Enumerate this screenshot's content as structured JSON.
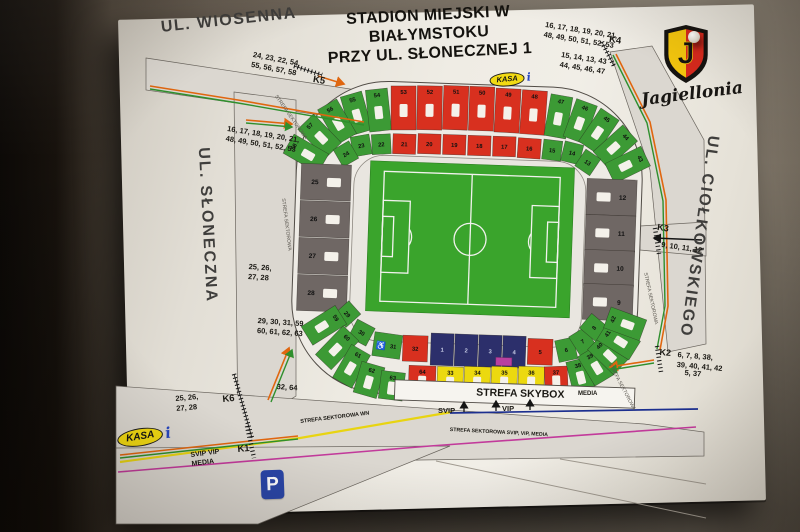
{
  "scene": {
    "wall_dark": "#0b0907",
    "wall_light": "#8a8173",
    "poster_color": "#efece4"
  },
  "title": {
    "line1": "STADION MIEJSKI W",
    "line2": "BIAŁYMSTOKU",
    "line3": "PRZY UL. SŁONECZNEJ 1"
  },
  "logo": {
    "name": "Jagiellonia",
    "initial": "J",
    "shield_yellow": "#f2c50e",
    "shield_red": "#d5291d"
  },
  "map": {
    "kasa_label": "KASA",
    "info_label": "i",
    "parking_label": "P",
    "skybox_label": "STREFA SKYBOX",
    "labels": [
      {
        "name": "street-wiosenna",
        "text": "UL. WIOSENNA",
        "x": 160,
        "y": 18,
        "rot": -6,
        "size": 16,
        "color": "#3f3e3c",
        "ls": 1.5
      },
      {
        "name": "sector-list-nw",
        "text": "24, 23, 22, 54,\n55, 56, 57, 58",
        "x": 254,
        "y": 50,
        "rot": 11,
        "size": 7.5
      },
      {
        "name": "gate-label-k5",
        "text": "K5",
        "x": 314,
        "y": 74,
        "rot": 10,
        "size": 9.5
      },
      {
        "name": "strefa-road-nw",
        "text": "STREFA SEKTOROWA",
        "x": 278,
        "y": 94,
        "rot": 55,
        "size": 5,
        "color": "#5a564f",
        "bold": false
      },
      {
        "name": "sector-list-w",
        "text": "16, 17, 18, 19, 20, 21,\n48, 49, 50, 51, 52, 53",
        "x": 228,
        "y": 124,
        "rot": 9,
        "size": 7.5
      },
      {
        "name": "street-sloneczna",
        "text": "UL. SŁONECZNA",
        "x": 192,
        "y": 148,
        "rot": -3,
        "size": 16,
        "color": "#3f3e3c",
        "vertical": true,
        "ls": 2
      },
      {
        "name": "strefa-road-w",
        "text": "STREFA SEKTOROWA",
        "x": 286,
        "y": 198,
        "rot": 83,
        "size": 5,
        "color": "#5a564f",
        "bold": false
      },
      {
        "name": "sector-list-w2",
        "text": "25, 26,\n27, 28",
        "x": 249,
        "y": 262,
        "rot": 4,
        "size": 7.5
      },
      {
        "name": "sector-list-sw",
        "text": "29, 30, 31, 59\n60, 61, 62, 63",
        "x": 258,
        "y": 316,
        "rot": 4,
        "size": 7.5
      },
      {
        "name": "sector-list-sw2",
        "text": "32, 64",
        "x": 277,
        "y": 382,
        "rot": 4,
        "size": 7.5
      },
      {
        "name": "sector-list-k6",
        "text": "25, 26,\n27, 28",
        "x": 175,
        "y": 394,
        "rot": -5,
        "size": 7.5
      },
      {
        "name": "gate-label-k6",
        "text": "K6",
        "x": 222,
        "y": 394,
        "rot": -5,
        "size": 9.5
      },
      {
        "name": "route-label-svip-vip-media",
        "text": "SVIP  VIP\nMEDIA",
        "x": 190,
        "y": 451,
        "rot": -7,
        "size": 7
      },
      {
        "name": "gate-label-k1",
        "text": "K1",
        "x": 237,
        "y": 444,
        "rot": -5,
        "size": 9.5
      },
      {
        "name": "strefa-sektorowa-wn",
        "text": "STREFA SEKTOROWA WN",
        "x": 300,
        "y": 419,
        "rot": -7,
        "size": 5.5
      },
      {
        "name": "svip-label",
        "text": "SVIP",
        "x": 438,
        "y": 406,
        "rot": 0,
        "size": 7.5
      },
      {
        "name": "vip-label",
        "text": "VIP",
        "x": 502,
        "y": 404,
        "rot": 0,
        "size": 7.5
      },
      {
        "name": "strefa-sektorowa-svip",
        "text": "STREFA SEKTOROWA SVIP, VIP, MEDIA",
        "x": 450,
        "y": 427,
        "rot": 3,
        "size": 5.2
      },
      {
        "name": "media-label",
        "text": "MEDIA",
        "x": 578,
        "y": 391,
        "rot": 0,
        "size": 6
      },
      {
        "name": "sector-list-ne",
        "text": "16, 17, 18, 19, 20, 21,\n48, 49, 50, 51, 52, 53",
        "x": 546,
        "y": 20,
        "rot": 9,
        "size": 7.5
      },
      {
        "name": "gate-label-k4",
        "text": "K4",
        "x": 610,
        "y": 34,
        "rot": 9,
        "size": 9.5
      },
      {
        "name": "sector-list-ne2",
        "text": "15, 14, 13, 43\n44, 45, 46, 47",
        "x": 562,
        "y": 50,
        "rot": 9,
        "size": 7.5
      },
      {
        "name": "street-ciolkowskiego",
        "text": "UL. CIOŁKOWSKIEGO",
        "x": 702,
        "y": 134,
        "rot": 8,
        "size": 16,
        "color": "#3f3e3c",
        "vertical": true,
        "ls": 2
      },
      {
        "name": "strefa-road-e",
        "text": "STREFA SEKTOROWA",
        "x": 648,
        "y": 272,
        "rot": 78,
        "size": 5,
        "color": "#5a564f",
        "bold": false
      },
      {
        "name": "gate-label-k3",
        "text": "K3",
        "x": 658,
        "y": 222,
        "rot": 8,
        "size": 9
      },
      {
        "name": "sector-list-e",
        "text": "9, 10, 11, 12",
        "x": 662,
        "y": 240,
        "rot": 8,
        "size": 7.5
      },
      {
        "name": "gate-label-k2",
        "text": "K2",
        "x": 660,
        "y": 347,
        "rot": 5,
        "size": 9
      },
      {
        "name": "sector-list-se",
        "text": "6, 7, 8, 38,\n39, 40, 41, 42",
        "x": 678,
        "y": 350,
        "rot": 5,
        "size": 7.5
      },
      {
        "name": "sector-list-se2",
        "text": "5, 37",
        "x": 685,
        "y": 368,
        "rot": 5,
        "size": 7.5
      },
      {
        "name": "strefa-road-se",
        "text": "STREFA SEKTOROWA",
        "x": 612,
        "y": 362,
        "rot": 62,
        "size": 5,
        "color": "#5a564f",
        "bold": false
      }
    ]
  },
  "stadium": {
    "colors": {
      "red": "#d8301f",
      "green": "#3c9a35",
      "gray": "#6f6764",
      "navy": "#2c2f6b",
      "yellow": "#ecd90f",
      "magenta": "#b8409f",
      "pitch": "#3aa42c",
      "ring": "#eeebe5",
      "slot": "#f4f1ea"
    },
    "wheelchair_symbol": "♿",
    "sectors": [
      {
        "n": "55",
        "x": 352,
        "y": 117,
        "w": 22,
        "h": 40,
        "r": -18,
        "c": "green",
        "s": "c"
      },
      {
        "n": "54",
        "x": 374,
        "y": 113,
        "w": 22,
        "h": 42,
        "r": -8,
        "c": "green",
        "s": "c"
      },
      {
        "n": "53",
        "x": 399,
        "y": 110,
        "w": 25,
        "h": 44,
        "r": -2,
        "c": "red",
        "s": "c"
      },
      {
        "n": "52",
        "x": 425,
        "y": 109,
        "w": 25,
        "h": 44,
        "r": -1,
        "c": "red",
        "s": "c"
      },
      {
        "n": "51",
        "x": 451,
        "y": 108,
        "w": 25,
        "h": 44,
        "r": 0,
        "c": "red",
        "s": "c"
      },
      {
        "n": "50",
        "x": 477,
        "y": 108,
        "w": 25,
        "h": 44,
        "r": 0,
        "c": "red",
        "s": "c"
      },
      {
        "n": "49",
        "x": 503,
        "y": 109,
        "w": 25,
        "h": 44,
        "r": 1,
        "c": "red",
        "s": "c"
      },
      {
        "n": "48",
        "x": 529,
        "y": 110,
        "w": 25,
        "h": 44,
        "r": 2,
        "c": "red",
        "s": "c"
      },
      {
        "n": "47",
        "x": 554,
        "y": 113,
        "w": 22,
        "h": 42,
        "r": 8,
        "c": "green",
        "s": "c"
      },
      {
        "n": "46",
        "x": 576,
        "y": 117,
        "w": 22,
        "h": 40,
        "r": 18,
        "c": "green",
        "s": "c"
      },
      {
        "n": "56",
        "x": 333,
        "y": 126,
        "w": 22,
        "h": 40,
        "r": -32,
        "c": "green",
        "s": "c"
      },
      {
        "n": "57",
        "x": 316,
        "y": 141,
        "w": 22,
        "h": 40,
        "r": -46,
        "c": "green",
        "s": "c"
      },
      {
        "n": "58",
        "x": 303,
        "y": 159,
        "w": 22,
        "h": 40,
        "r": -62,
        "c": "green",
        "s": "c"
      },
      {
        "n": "45",
        "x": 595,
        "y": 126,
        "w": 22,
        "h": 40,
        "r": 32,
        "c": "green",
        "s": "c"
      },
      {
        "n": "44",
        "x": 612,
        "y": 141,
        "w": 22,
        "h": 40,
        "r": 46,
        "c": "green",
        "s": "c"
      },
      {
        "n": "43",
        "x": 625,
        "y": 159,
        "w": 22,
        "h": 40,
        "r": 62,
        "c": "green",
        "s": "c"
      },
      {
        "n": "23",
        "x": 358,
        "y": 149,
        "w": 19,
        "h": 20,
        "r": -12,
        "c": "green"
      },
      {
        "n": "22",
        "x": 378,
        "y": 147,
        "w": 19,
        "h": 20,
        "r": -5,
        "c": "green"
      },
      {
        "n": "21",
        "x": 401,
        "y": 146,
        "w": 23,
        "h": 20,
        "r": 0,
        "c": "red"
      },
      {
        "n": "20",
        "x": 426,
        "y": 145,
        "w": 23,
        "h": 20,
        "r": 0,
        "c": "red"
      },
      {
        "n": "19",
        "x": 451,
        "y": 145,
        "w": 23,
        "h": 20,
        "r": 0,
        "c": "red"
      },
      {
        "n": "18",
        "x": 476,
        "y": 145,
        "w": 23,
        "h": 20,
        "r": 0,
        "c": "red"
      },
      {
        "n": "17",
        "x": 501,
        "y": 145,
        "w": 23,
        "h": 20,
        "r": 0,
        "c": "red"
      },
      {
        "n": "16",
        "x": 526,
        "y": 146,
        "w": 23,
        "h": 20,
        "r": 2,
        "c": "red"
      },
      {
        "n": "15",
        "x": 549,
        "y": 147,
        "w": 19,
        "h": 20,
        "r": 5,
        "c": "green"
      },
      {
        "n": "14",
        "x": 569,
        "y": 149,
        "w": 19,
        "h": 20,
        "r": 12,
        "c": "green"
      },
      {
        "n": "24",
        "x": 343,
        "y": 158,
        "w": 18,
        "h": 20,
        "r": -32,
        "c": "green"
      },
      {
        "n": "13",
        "x": 585,
        "y": 158,
        "w": 18,
        "h": 20,
        "r": 32,
        "c": "green"
      },
      {
        "n": "25",
        "x": 324,
        "y": 187,
        "w": 50,
        "h": 36,
        "r": 0,
        "c": "gray",
        "s": "r"
      },
      {
        "n": "26",
        "x": 324,
        "y": 224,
        "w": 50,
        "h": 36,
        "r": 0,
        "c": "gray",
        "s": "r"
      },
      {
        "n": "27",
        "x": 324,
        "y": 261,
        "w": 50,
        "h": 36,
        "r": 0,
        "c": "gray",
        "s": "r"
      },
      {
        "n": "28",
        "x": 324,
        "y": 298,
        "w": 50,
        "h": 36,
        "r": 0,
        "c": "gray",
        "s": "r"
      },
      {
        "n": "12",
        "x": 610,
        "y": 192,
        "w": 50,
        "h": 36,
        "r": 0,
        "c": "gray",
        "s": "l"
      },
      {
        "n": "11",
        "x": 610,
        "y": 228,
        "w": 50,
        "h": 36,
        "r": 0,
        "c": "gray",
        "s": "l"
      },
      {
        "n": "10",
        "x": 610,
        "y": 263,
        "w": 50,
        "h": 36,
        "r": 0,
        "c": "gray",
        "s": "l"
      },
      {
        "n": "9",
        "x": 610,
        "y": 297,
        "w": 50,
        "h": 36,
        "r": 0,
        "c": "gray",
        "s": "l"
      },
      {
        "n": "29",
        "x": 350,
        "y": 318,
        "w": 18,
        "h": 20,
        "r": 46,
        "c": "green"
      },
      {
        "n": "30",
        "x": 365,
        "y": 336,
        "w": 20,
        "h": 20,
        "r": 26,
        "c": "green"
      },
      {
        "n": "31",
        "x": 391,
        "y": 348,
        "w": 28,
        "h": 24,
        "r": 6,
        "c": "green",
        "wc": true
      },
      {
        "n": "32",
        "x": 419,
        "y": 350,
        "w": 25,
        "h": 26,
        "r": 0,
        "c": "red"
      },
      {
        "n": "1",
        "x": 446,
        "y": 350,
        "w": 23,
        "h": 32,
        "r": 0,
        "c": "navy"
      },
      {
        "n": "2",
        "x": 470,
        "y": 350,
        "w": 23,
        "h": 32,
        "r": 0,
        "c": "navy"
      },
      {
        "n": "3",
        "x": 494,
        "y": 350,
        "w": 23,
        "h": 32,
        "r": 0,
        "c": "navy"
      },
      {
        "n": "4",
        "x": 518,
        "y": 350,
        "w": 23,
        "h": 32,
        "r": 0,
        "c": "navy"
      },
      {
        "n": "5",
        "x": 544,
        "y": 349,
        "w": 25,
        "h": 26,
        "r": 0,
        "c": "red"
      },
      {
        "n": "6",
        "x": 570,
        "y": 346,
        "w": 19,
        "h": 22,
        "r": -14,
        "c": "green"
      },
      {
        "n": "7",
        "x": 586,
        "y": 337,
        "w": 19,
        "h": 22,
        "r": -34,
        "c": "green"
      },
      {
        "n": "8",
        "x": 597,
        "y": 323,
        "w": 19,
        "h": 22,
        "r": -52,
        "c": "green"
      },
      {
        "n": "59",
        "x": 327,
        "y": 330,
        "w": 22,
        "h": 40,
        "r": 56,
        "c": "green",
        "s": "c"
      },
      {
        "n": "60",
        "x": 341,
        "y": 352,
        "w": 22,
        "h": 40,
        "r": 42,
        "c": "green",
        "s": "c"
      },
      {
        "n": "61",
        "x": 356,
        "y": 370,
        "w": 22,
        "h": 38,
        "r": 28,
        "c": "green",
        "s": "c"
      },
      {
        "n": "62",
        "x": 374,
        "y": 383,
        "w": 24,
        "h": 32,
        "r": 14,
        "c": "green",
        "s": "c"
      },
      {
        "n": "63",
        "x": 397,
        "y": 388,
        "w": 24,
        "h": 28,
        "r": 5,
        "c": "green",
        "s": "c"
      },
      {
        "n": "64",
        "x": 427,
        "y": 381,
        "w": 27,
        "h": 28,
        "r": 0,
        "c": "red",
        "s": "c"
      },
      {
        "n": "33",
        "x": 455,
        "y": 381,
        "w": 26,
        "h": 28,
        "r": 0,
        "c": "yellow",
        "s": "c"
      },
      {
        "n": "34",
        "x": 482,
        "y": 380,
        "w": 26,
        "h": 28,
        "r": 0,
        "c": "yellow",
        "s": "c"
      },
      {
        "n": "35",
        "x": 509,
        "y": 379,
        "w": 26,
        "h": 28,
        "r": 0,
        "c": "yellow",
        "s": "c"
      },
      {
        "n": "36",
        "x": 536,
        "y": 378,
        "w": 26,
        "h": 28,
        "r": 0,
        "c": "yellow",
        "s": "c"
      },
      {
        "n": "37",
        "x": 561,
        "y": 376,
        "w": 23,
        "h": 26,
        "r": -4,
        "c": "red",
        "s": "c"
      },
      {
        "n": "38",
        "x": 585,
        "y": 371,
        "w": 22,
        "h": 32,
        "r": -16,
        "c": "green",
        "s": "c"
      },
      {
        "n": "39",
        "x": 600,
        "y": 361,
        "w": 22,
        "h": 34,
        "r": -33,
        "c": "green",
        "s": "c"
      },
      {
        "n": "40",
        "x": 612,
        "y": 349,
        "w": 22,
        "h": 36,
        "r": -48,
        "c": "green",
        "s": "c"
      },
      {
        "n": "41",
        "x": 622,
        "y": 335,
        "w": 22,
        "h": 38,
        "r": -60,
        "c": "green",
        "s": "c"
      },
      {
        "n": "42",
        "x": 628,
        "y": 318,
        "w": 22,
        "h": 38,
        "r": -72,
        "c": "green",
        "s": "c"
      }
    ]
  }
}
